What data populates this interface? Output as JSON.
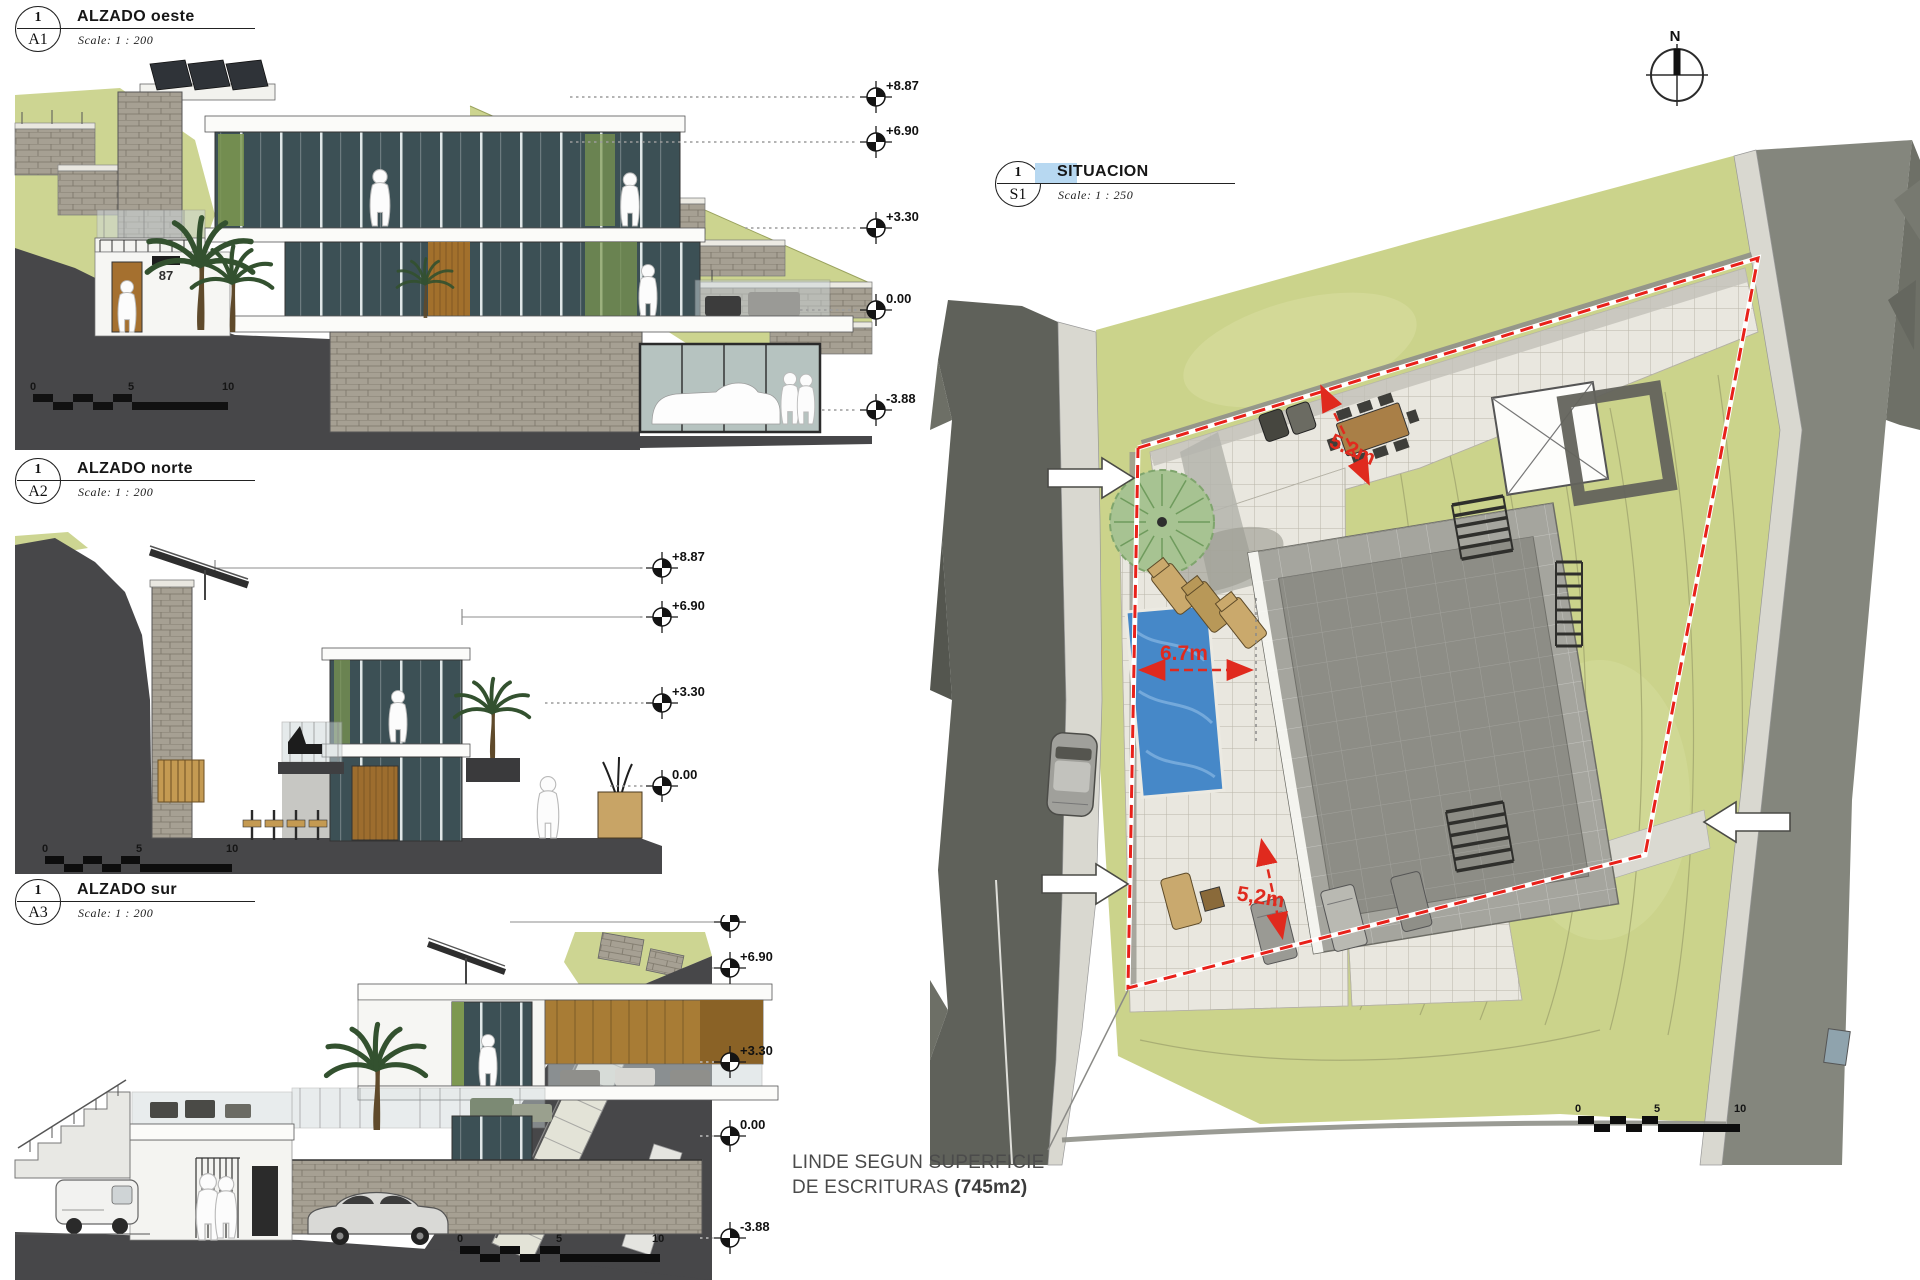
{
  "sheet": {
    "views": {
      "a1": {
        "num": "1",
        "ref": "A1",
        "title": "ALZADO oeste",
        "scale": "Scale: 1 : 200"
      },
      "a2": {
        "num": "1",
        "ref": "A2",
        "title": "ALZADO norte",
        "scale": "Scale: 1 : 200"
      },
      "a3": {
        "num": "1",
        "ref": "A3",
        "title": "ALZADO sur",
        "scale": "Scale: 1 : 200"
      },
      "s1": {
        "num": "1",
        "ref": "S1",
        "title": "SITUACION",
        "scale": "Scale: 1 : 250"
      }
    }
  },
  "levels": {
    "oeste": [
      "+8.87",
      "+6.90",
      "+3.30",
      "0.00",
      "-3.88"
    ],
    "norte": [
      "+8.87",
      "+6.90",
      "+3.30",
      "0.00"
    ],
    "sur": [
      "+8.87",
      "+6.90",
      "+3.30",
      "0.00",
      "-3.88"
    ]
  },
  "scale_bar": {
    "zero": "0",
    "mid": "5",
    "end": "10"
  },
  "site": {
    "north_label": "N",
    "dim_upper": "5.2m",
    "dim_pool": "6.7m",
    "dim_lower": "5,2m",
    "note_line1": "LINDE SEGUN SUPERFICIE",
    "note_line2": "DE ESCRITURAS ",
    "note_bold": "(745m2)"
  },
  "elevation": {
    "house_number": "87"
  },
  "colors": {
    "boundary_red": "#e8211a",
    "dim_red": "#e02a1e",
    "pool_blue": "#4688c8",
    "grass": "#cbd38b",
    "ground_dark": "#474749"
  }
}
